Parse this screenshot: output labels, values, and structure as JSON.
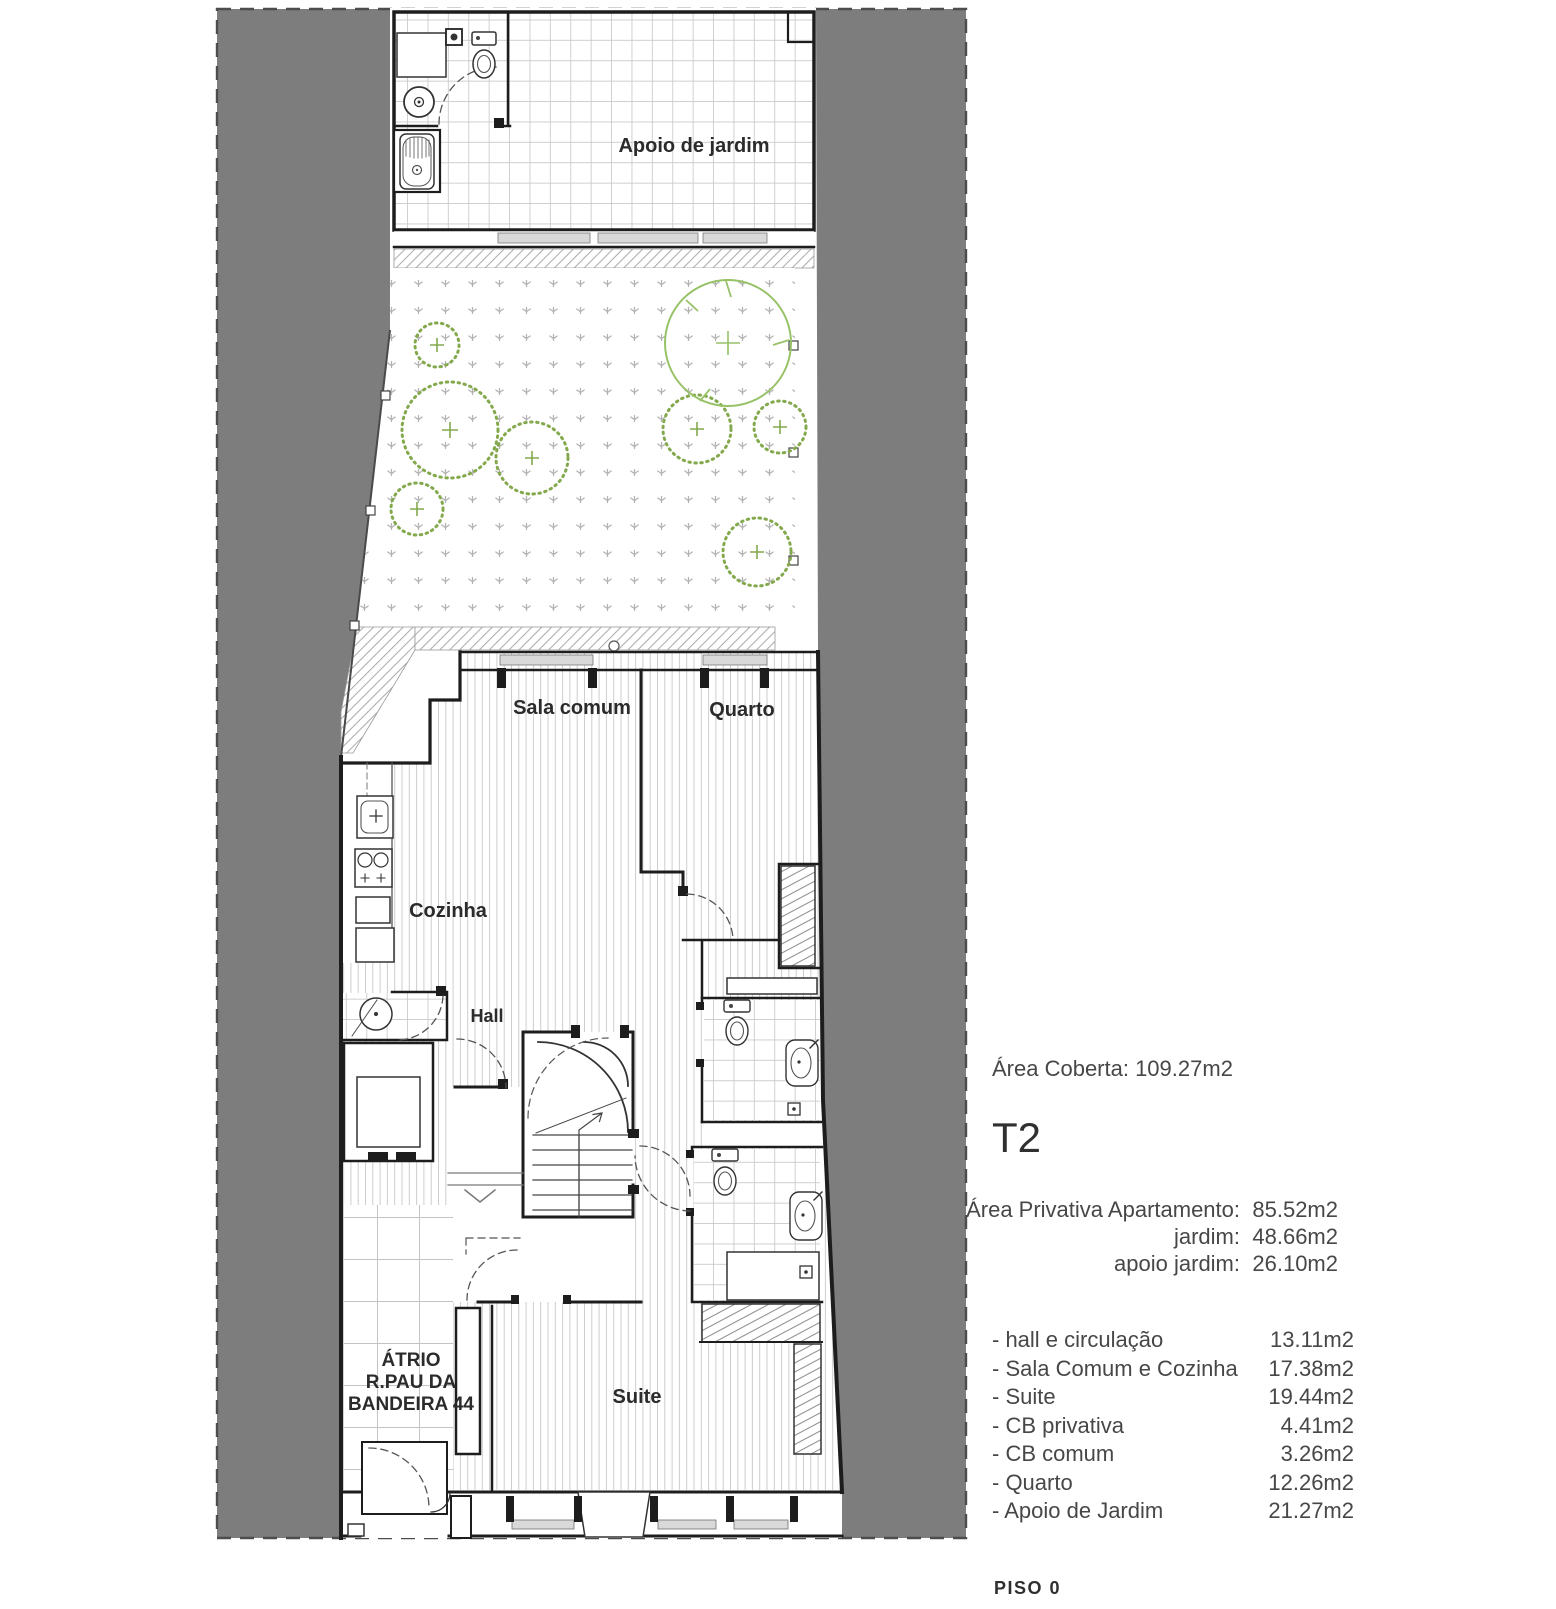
{
  "plan": {
    "rooms": {
      "apoio": "Apoio de jardim",
      "sala": "Sala comum",
      "quarto": "Quarto",
      "cozinha": "Cozinha",
      "hall": "Hall",
      "suite": "Suite",
      "atrio_line1": "ÁTRIO",
      "atrio_line2": "R.PAU DA",
      "atrio_line3": "BANDEIRA 44"
    },
    "colors": {
      "site_gray": "#7d7d7d",
      "wall": "#1d1d1d",
      "shrub_green": "#83a94c",
      "tree_green": "#97c267",
      "sill_gray": "#d9d9d9"
    }
  },
  "info_panel": {
    "area_coberta": "Área Coberta: 109.27m2",
    "unit_type": "T2",
    "private_areas": [
      {
        "label": "Área Privativa Apartamento:",
        "value": "85.52m2"
      },
      {
        "label": "jardim:",
        "value": "48.66m2"
      },
      {
        "label": "apoio jardim:",
        "value": "26.10m2"
      }
    ],
    "room_areas": [
      {
        "label": "- hall e circulação",
        "value": "13.11m2"
      },
      {
        "label": "- Sala Comum e Cozinha",
        "value": "17.38m2"
      },
      {
        "label": "- Suite",
        "value": "19.44m2"
      },
      {
        "label": "- CB privativa",
        "value": "4.41m2"
      },
      {
        "label": "- CB comum",
        "value": "3.26m2"
      },
      {
        "label": "- Quarto",
        "value": "12.26m2"
      },
      {
        "label": "- Apoio de Jardim",
        "value": "21.27m2"
      }
    ],
    "floor_label": "PISO 0"
  }
}
